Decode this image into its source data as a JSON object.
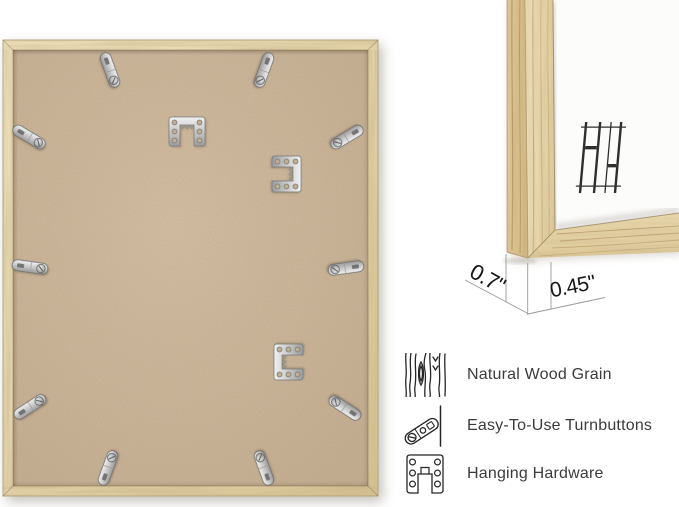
{
  "product_back": {
    "turnbutton_count": 10,
    "hanger_count": 3
  },
  "dimensions": {
    "depth": "0.7\"",
    "face_width": "0.45\""
  },
  "features": {
    "items": [
      {
        "icon": "wood-grain-icon",
        "label": "Natural Wood Grain"
      },
      {
        "icon": "turnbutton-icon",
        "label": "Easy-To-Use Turnbuttons"
      },
      {
        "icon": "hanging-hardware-icon",
        "label": "Hanging Hardware"
      }
    ]
  },
  "brand": {
    "monogram": "HH"
  },
  "colors": {
    "wood": "#e6d4a9",
    "mdf": "#c9b499",
    "metal": "#cfcfcf",
    "label_text": "#3b3b3b",
    "dim_line": "#9a9a9a",
    "background": "#ffffff"
  }
}
